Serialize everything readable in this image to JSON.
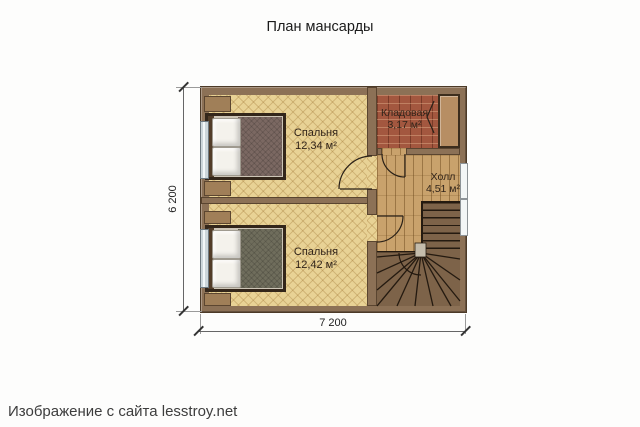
{
  "title": "План мансарды",
  "footer_credit": "Изображение с сайта lesstroy.net",
  "plan": {
    "type": "attic floor plan",
    "rooms": [
      {
        "name": "Спальня",
        "area": "12,34 м²"
      },
      {
        "name": "Кладовая",
        "area": "3,17 м²"
      },
      {
        "name": "Холл",
        "area": "4,51 м²"
      },
      {
        "name": "Спальня",
        "area": "12,42 м²"
      }
    ],
    "dimensions": {
      "width": "7 200",
      "height": "6 200"
    },
    "features": [
      "double-bed-top",
      "double-bed-bottom",
      "winder-staircase",
      "wardrobe",
      "left-windows",
      "right-window",
      "door-swings"
    ],
    "colors": {
      "wall": "#8c7156",
      "bedroom_floor": "#e8d295",
      "storage_floor": "#a3573f",
      "hall_floor": "#c9a26c",
      "stairs": "#7d6349",
      "blanket_top": "#7b6862",
      "blanket_bottom": "#6f6d5c",
      "window_glass": "#ccd6da"
    }
  }
}
